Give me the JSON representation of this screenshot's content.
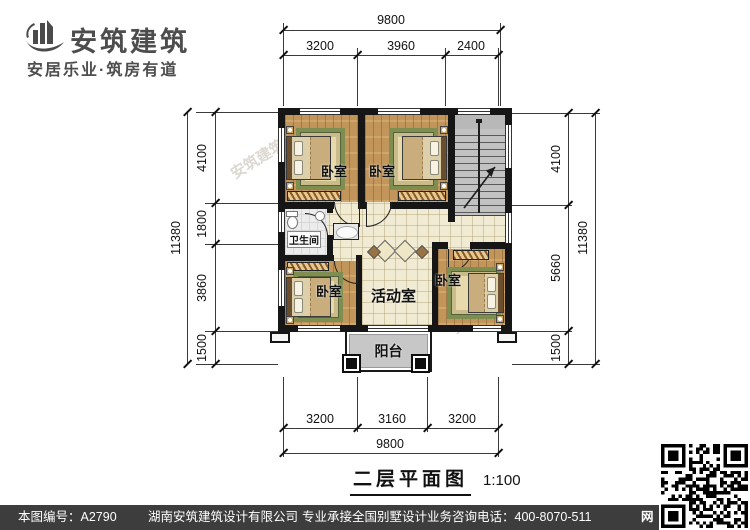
{
  "branding": {
    "company_name": "安筑建筑",
    "tagline": "安居乐业·筑房有道"
  },
  "plan": {
    "title": "二层平面图",
    "scale": "1:100",
    "rooms": {
      "bedroom_a": "卧室",
      "bedroom_b": "卧室",
      "bathroom": "卫生间",
      "bedroom_c": "卧室",
      "activity": "活动室",
      "bedroom_d": "卧室",
      "balcony": "阳台"
    },
    "dims": {
      "top": {
        "total": "9800",
        "segs": [
          "3200",
          "3960",
          "2400"
        ]
      },
      "bottom": {
        "total": "9800",
        "segs": [
          "3200",
          "3160",
          "3200"
        ]
      },
      "left": {
        "total": "11380",
        "segs": [
          "4100",
          "1800",
          "3860",
          "1500"
        ]
      },
      "right": {
        "total": "11380",
        "segs": [
          "4100",
          "5660",
          "1500"
        ]
      }
    }
  },
  "watermarks": [
    "安筑建筑com",
    "安筑建筑",
    "安筑建筑"
  ],
  "footer": {
    "drawing_no": "本图编号：A2790",
    "company": "湖南安筑建筑设计有限公司",
    "service": "专业承接全国别墅设计业务",
    "phone": "咨询电话：400-8070-511",
    "web_badge": "网"
  },
  "colors": {
    "wall": "#161616",
    "wood_floor": "#c2955a",
    "tile_floor": "#f2ebd3",
    "stairs": "#b8b8b8",
    "footer_bar": "#3d3d3d",
    "logo_text": "#4d4d4d",
    "rug_border": "#7e8e51"
  }
}
